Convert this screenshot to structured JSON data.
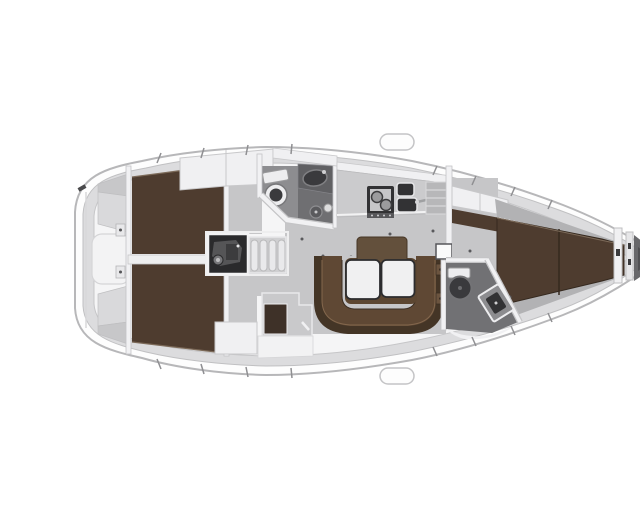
{
  "meta": {
    "title": "Sailing yacht interior layout plan, top-down view, bow to the right",
    "view": "top-down-floor-plan",
    "orientation": "bow-right"
  },
  "colors": {
    "background": "#ffffff",
    "hull_fill": "#fdfdfd",
    "hull_stroke": "#b7b7b9",
    "deck_fill": "#dcdcde",
    "deck_stroke": "#c0c0c2",
    "interior_fill": "#f5f5f6",
    "interior_stroke": "#c6c6c8",
    "floor": "#c6c6c8",
    "wood": "#4e3c2f",
    "wood_seam": "#35291f",
    "wood_highlight": "#7c6a59",
    "sofa_seat": "#5f4834",
    "sofa_back": "#443526",
    "table_wood": "#5c4631",
    "backrest_wood": "#63503c",
    "tabletop": "#f0f0f1",
    "tabletop_stroke": "#2c2c2e",
    "white_furniture": "#f0f0f2",
    "furniture_stroke": "#c8c8ca",
    "wall": "#f1f1f3",
    "wall_stroke": "#c4c4c6",
    "head_floor": "#8d8d90",
    "shower_floor": "#6f6f72",
    "fwd_head_floor": "#717174",
    "counter": "#cbcbcd",
    "counter_unit": "#b7b7b9",
    "fixture_dark": "#323234",
    "fixture_mid": "#606063",
    "toilet_white": "#ededef",
    "toilet_dark": "#3a3a3d",
    "engine_box": "#2a2a2c",
    "engine_part": "#77777a",
    "step_fill": "#e9e9eb",
    "step_stroke": "#b9b9bb",
    "hinge": "#6b543f",
    "dot": "#59595c",
    "lining": "#b2b2b4",
    "lazarette_light": "#d9d9db",
    "lazarette_dark": "#c7c7c9",
    "locker": "#68686b",
    "locker_dark": "#505053",
    "tick": "#8f8f92"
  },
  "rooms": [
    {
      "name": "stern-deck",
      "features": [
        "transom",
        "lazarette-locker-port",
        "lazarette-locker-starboard",
        "walkthrough",
        "cleat"
      ]
    },
    {
      "name": "aft-cabin-starboard",
      "features": [
        "double-berth",
        "wardrobe",
        "entry-floor"
      ]
    },
    {
      "name": "aft-cabin-port",
      "features": [
        "double-berth",
        "wardrobe",
        "entry-floor"
      ]
    },
    {
      "name": "engine-room",
      "features": [
        "engine-block"
      ]
    },
    {
      "name": "companionway",
      "features": [
        "four-steps"
      ]
    },
    {
      "name": "aft-head",
      "features": [
        "toilet",
        "washbasin",
        "shower-drain",
        "hand-shower"
      ]
    },
    {
      "name": "galley",
      "features": [
        "two-burner-stove",
        "double-sink",
        "faucet",
        "refrigerator-unit"
      ]
    },
    {
      "name": "salon",
      "features": [
        "u-shaped-sofa",
        "folding-table",
        "two-tabletops",
        "backrest",
        "nav-cabinet"
      ]
    },
    {
      "name": "forward-head",
      "features": [
        "toilet",
        "tilted-washbasin"
      ]
    },
    {
      "name": "forward-cabin",
      "features": [
        "v-berth",
        "shelf-cabinet",
        "side-lining"
      ]
    },
    {
      "name": "bow",
      "features": [
        "chain-locker-bulkheads",
        "anchor-locker"
      ]
    }
  ]
}
